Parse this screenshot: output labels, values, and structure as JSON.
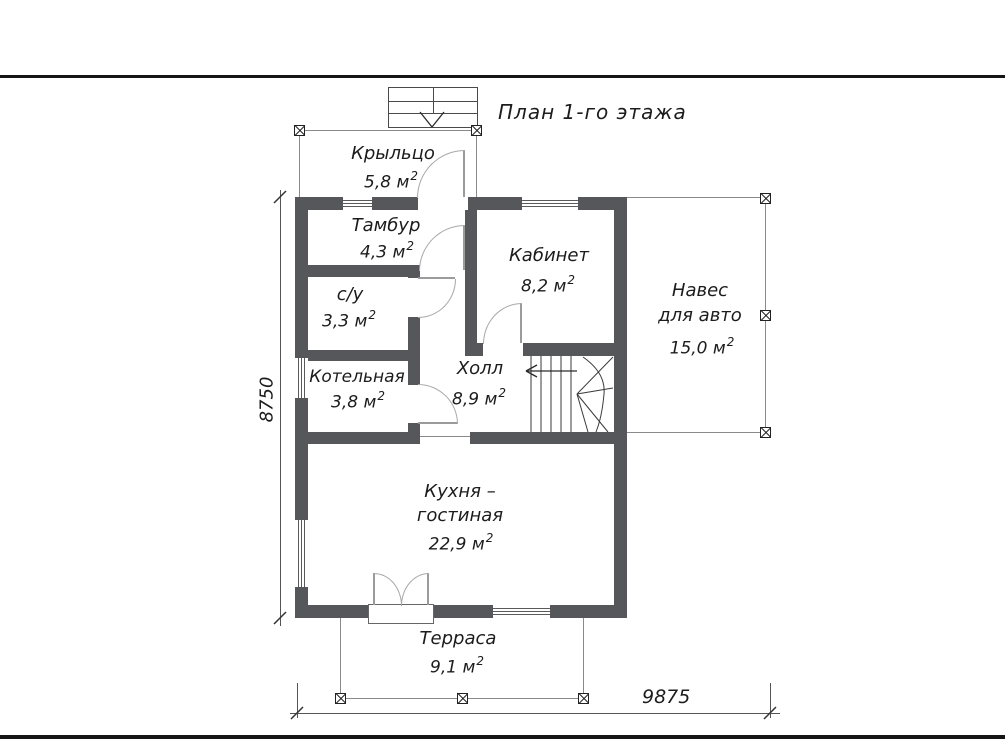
{
  "page": {
    "title": "План 1-го этажа"
  },
  "rooms": {
    "porch": {
      "name": "Крыльцо",
      "area": "5,8 м",
      "sup": "2"
    },
    "tambour": {
      "name": "Тамбур",
      "area": "4,3 м",
      "sup": "2"
    },
    "office": {
      "name": "Кабинет",
      "area": "8,2 м",
      "sup": "2"
    },
    "wc": {
      "name": "с/у",
      "area": "3,3 м",
      "sup": "2"
    },
    "boiler": {
      "name": "Котельная",
      "area": "3,8 м",
      "sup": "2"
    },
    "hall": {
      "name": "Холл",
      "area": "8,9 м",
      "sup": "2"
    },
    "carport": {
      "name_line1": "Навес",
      "name_line2": "для авто",
      "area": "15,0 м",
      "sup": "2"
    },
    "kitchen": {
      "name_line1": "Кухня –",
      "name_line2": "гостиная",
      "area": "22,9 м",
      "sup": "2"
    },
    "terrace": {
      "name": "Терраса",
      "area": "9,1 м",
      "sup": "2"
    }
  },
  "dimensions": {
    "height": "8750",
    "width": "9875"
  },
  "colors": {
    "wall": "#56575b",
    "outline": "#8a8a8a",
    "page_rule": "#151515"
  }
}
